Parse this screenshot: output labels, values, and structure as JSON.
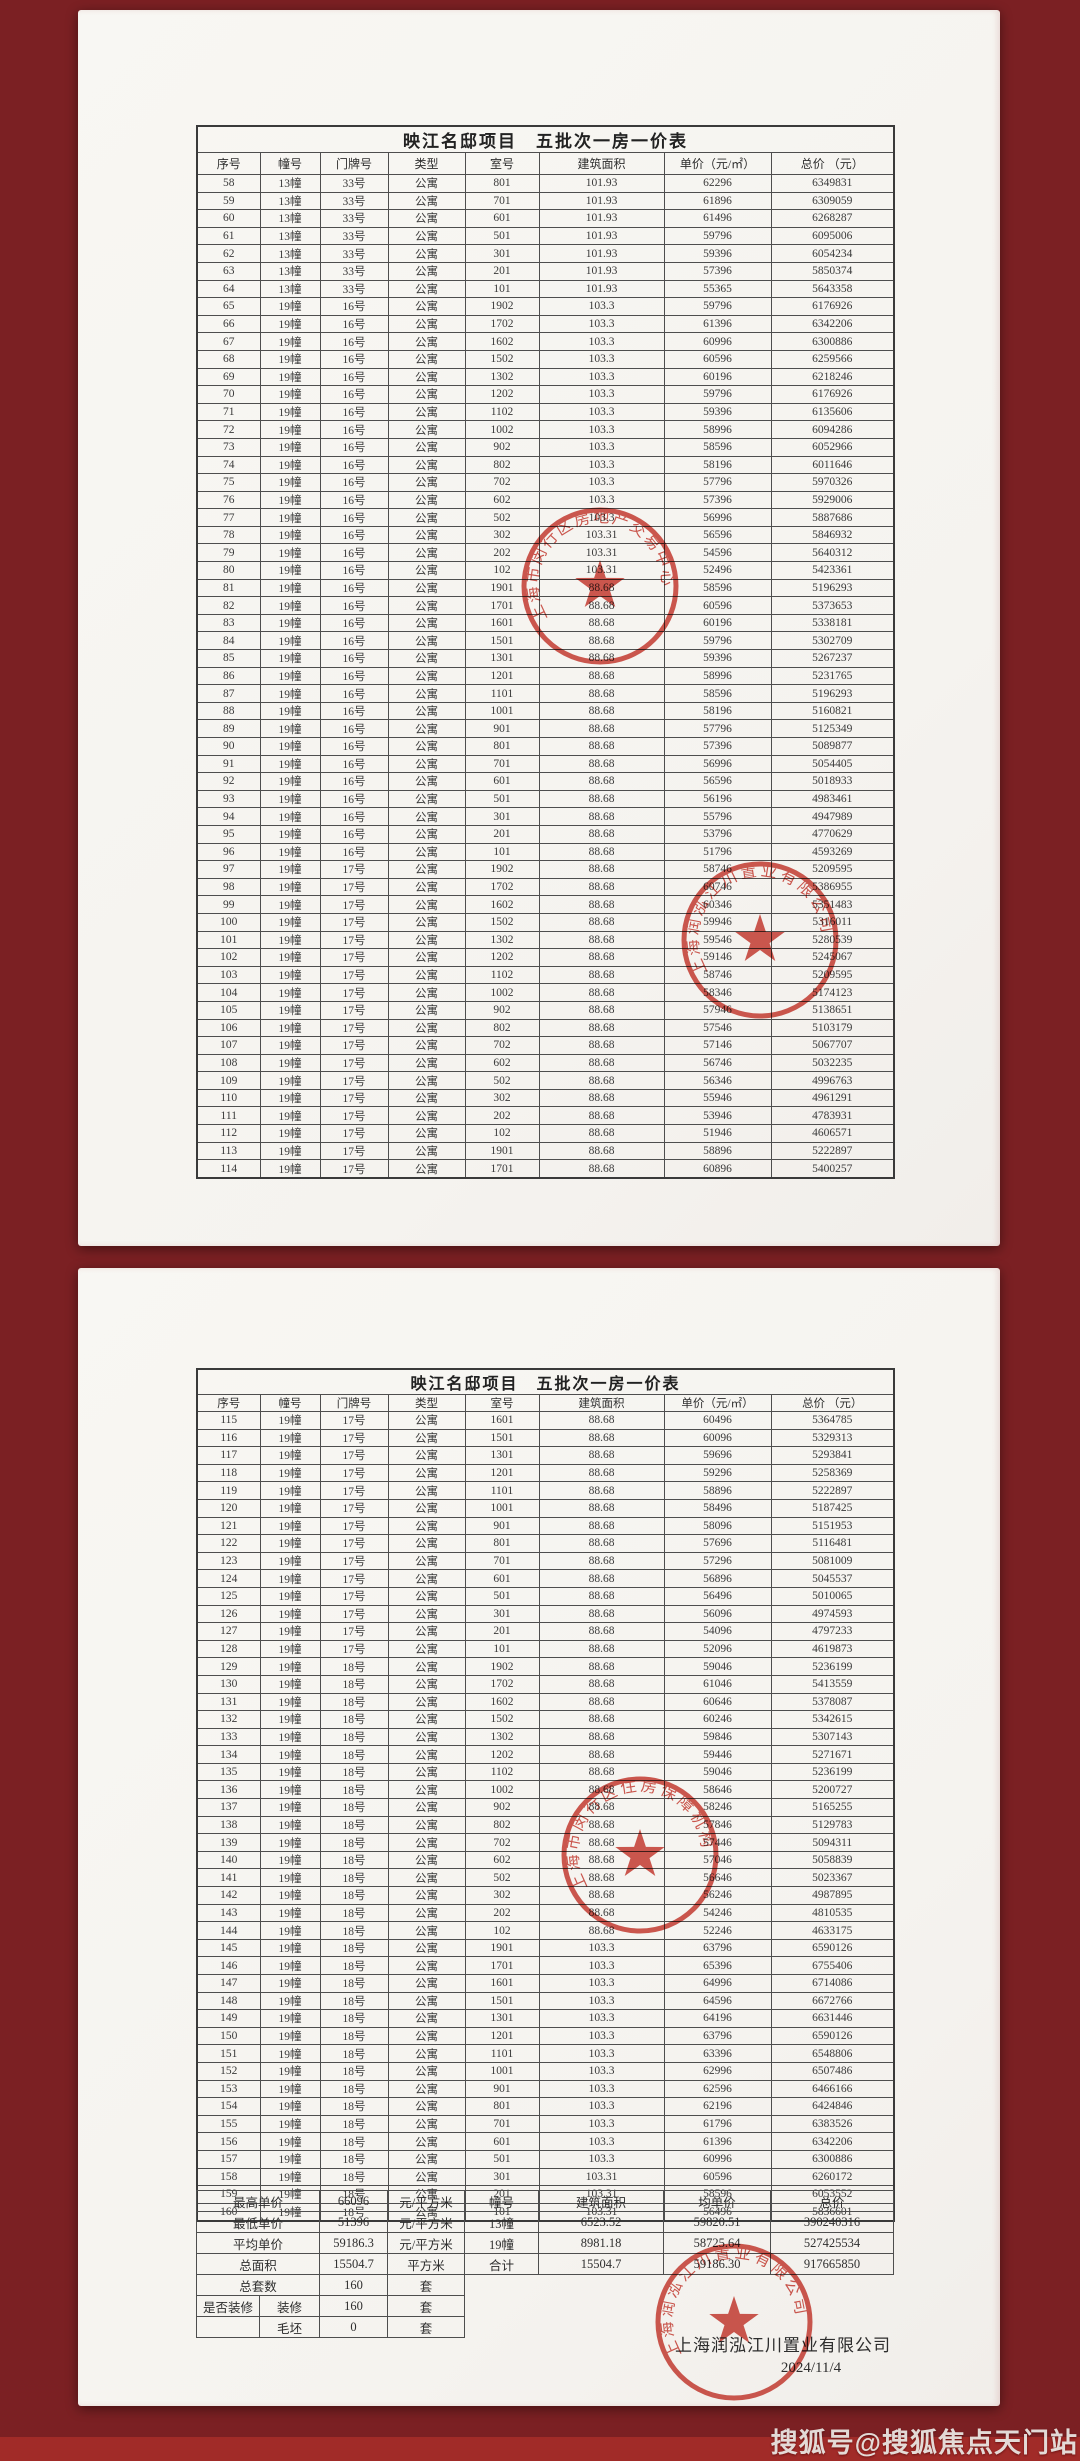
{
  "colors": {
    "background": "#7b2023",
    "bottom_band": "#a12b28",
    "paper": "#f7f5f1",
    "stamp_red": "#c8352b"
  },
  "watermark": "搜狐号@搜狐焦点天门站",
  "doc": {
    "title": "映江名邸项目　五批次一房一价表",
    "headers": [
      "序号",
      "幢号",
      "门牌号",
      "类型",
      "室号",
      "建筑面积",
      "单价（元/㎡）",
      "总价 （元）"
    ]
  },
  "page1": {
    "rows": [
      [
        "58",
        "13幢",
        "33号",
        "公寓",
        "801",
        "101.93",
        "62296",
        "6349831"
      ],
      [
        "59",
        "13幢",
        "33号",
        "公寓",
        "701",
        "101.93",
        "61896",
        "6309059"
      ],
      [
        "60",
        "13幢",
        "33号",
        "公寓",
        "601",
        "101.93",
        "61496",
        "6268287"
      ],
      [
        "61",
        "13幢",
        "33号",
        "公寓",
        "501",
        "101.93",
        "59796",
        "6095006"
      ],
      [
        "62",
        "13幢",
        "33号",
        "公寓",
        "301",
        "101.93",
        "59396",
        "6054234"
      ],
      [
        "63",
        "13幢",
        "33号",
        "公寓",
        "201",
        "101.93",
        "57396",
        "5850374"
      ],
      [
        "64",
        "13幢",
        "33号",
        "公寓",
        "101",
        "101.93",
        "55365",
        "5643358"
      ],
      [
        "65",
        "19幢",
        "16号",
        "公寓",
        "1902",
        "103.3",
        "59796",
        "6176926"
      ],
      [
        "66",
        "19幢",
        "16号",
        "公寓",
        "1702",
        "103.3",
        "61396",
        "6342206"
      ],
      [
        "67",
        "19幢",
        "16号",
        "公寓",
        "1602",
        "103.3",
        "60996",
        "6300886"
      ],
      [
        "68",
        "19幢",
        "16号",
        "公寓",
        "1502",
        "103.3",
        "60596",
        "6259566"
      ],
      [
        "69",
        "19幢",
        "16号",
        "公寓",
        "1302",
        "103.3",
        "60196",
        "6218246"
      ],
      [
        "70",
        "19幢",
        "16号",
        "公寓",
        "1202",
        "103.3",
        "59796",
        "6176926"
      ],
      [
        "71",
        "19幢",
        "16号",
        "公寓",
        "1102",
        "103.3",
        "59396",
        "6135606"
      ],
      [
        "72",
        "19幢",
        "16号",
        "公寓",
        "1002",
        "103.3",
        "58996",
        "6094286"
      ],
      [
        "73",
        "19幢",
        "16号",
        "公寓",
        "902",
        "103.3",
        "58596",
        "6052966"
      ],
      [
        "74",
        "19幢",
        "16号",
        "公寓",
        "802",
        "103.3",
        "58196",
        "6011646"
      ],
      [
        "75",
        "19幢",
        "16号",
        "公寓",
        "702",
        "103.3",
        "57796",
        "5970326"
      ],
      [
        "76",
        "19幢",
        "16号",
        "公寓",
        "602",
        "103.3",
        "57396",
        "5929006"
      ],
      [
        "77",
        "19幢",
        "16号",
        "公寓",
        "502",
        "103.3",
        "56996",
        "5887686"
      ],
      [
        "78",
        "19幢",
        "16号",
        "公寓",
        "302",
        "103.31",
        "56596",
        "5846932"
      ],
      [
        "79",
        "19幢",
        "16号",
        "公寓",
        "202",
        "103.31",
        "54596",
        "5640312"
      ],
      [
        "80",
        "19幢",
        "16号",
        "公寓",
        "102",
        "103.31",
        "52496",
        "5423361"
      ],
      [
        "81",
        "19幢",
        "16号",
        "公寓",
        "1901",
        "88.68",
        "58596",
        "5196293"
      ],
      [
        "82",
        "19幢",
        "16号",
        "公寓",
        "1701",
        "88.68",
        "60596",
        "5373653"
      ],
      [
        "83",
        "19幢",
        "16号",
        "公寓",
        "1601",
        "88.68",
        "60196",
        "5338181"
      ],
      [
        "84",
        "19幢",
        "16号",
        "公寓",
        "1501",
        "88.68",
        "59796",
        "5302709"
      ],
      [
        "85",
        "19幢",
        "16号",
        "公寓",
        "1301",
        "88.68",
        "59396",
        "5267237"
      ],
      [
        "86",
        "19幢",
        "16号",
        "公寓",
        "1201",
        "88.68",
        "58996",
        "5231765"
      ],
      [
        "87",
        "19幢",
        "16号",
        "公寓",
        "1101",
        "88.68",
        "58596",
        "5196293"
      ],
      [
        "88",
        "19幢",
        "16号",
        "公寓",
        "1001",
        "88.68",
        "58196",
        "5160821"
      ],
      [
        "89",
        "19幢",
        "16号",
        "公寓",
        "901",
        "88.68",
        "57796",
        "5125349"
      ],
      [
        "90",
        "19幢",
        "16号",
        "公寓",
        "801",
        "88.68",
        "57396",
        "5089877"
      ],
      [
        "91",
        "19幢",
        "16号",
        "公寓",
        "701",
        "88.68",
        "56996",
        "5054405"
      ],
      [
        "92",
        "19幢",
        "16号",
        "公寓",
        "601",
        "88.68",
        "56596",
        "5018933"
      ],
      [
        "93",
        "19幢",
        "16号",
        "公寓",
        "501",
        "88.68",
        "56196",
        "4983461"
      ],
      [
        "94",
        "19幢",
        "16号",
        "公寓",
        "301",
        "88.68",
        "55796",
        "4947989"
      ],
      [
        "95",
        "19幢",
        "16号",
        "公寓",
        "201",
        "88.68",
        "53796",
        "4770629"
      ],
      [
        "96",
        "19幢",
        "16号",
        "公寓",
        "101",
        "88.68",
        "51796",
        "4593269"
      ],
      [
        "97",
        "19幢",
        "17号",
        "公寓",
        "1902",
        "88.68",
        "58746",
        "5209595"
      ],
      [
        "98",
        "19幢",
        "17号",
        "公寓",
        "1702",
        "88.68",
        "60746",
        "5386955"
      ],
      [
        "99",
        "19幢",
        "17号",
        "公寓",
        "1602",
        "88.68",
        "60346",
        "5351483"
      ],
      [
        "100",
        "19幢",
        "17号",
        "公寓",
        "1502",
        "88.68",
        "59946",
        "5316011"
      ],
      [
        "101",
        "19幢",
        "17号",
        "公寓",
        "1302",
        "88.68",
        "59546",
        "5280539"
      ],
      [
        "102",
        "19幢",
        "17号",
        "公寓",
        "1202",
        "88.68",
        "59146",
        "5245067"
      ],
      [
        "103",
        "19幢",
        "17号",
        "公寓",
        "1102",
        "88.68",
        "58746",
        "5209595"
      ],
      [
        "104",
        "19幢",
        "17号",
        "公寓",
        "1002",
        "88.68",
        "58346",
        "5174123"
      ],
      [
        "105",
        "19幢",
        "17号",
        "公寓",
        "902",
        "88.68",
        "57946",
        "5138651"
      ],
      [
        "106",
        "19幢",
        "17号",
        "公寓",
        "802",
        "88.68",
        "57546",
        "5103179"
      ],
      [
        "107",
        "19幢",
        "17号",
        "公寓",
        "702",
        "88.68",
        "57146",
        "5067707"
      ],
      [
        "108",
        "19幢",
        "17号",
        "公寓",
        "602",
        "88.68",
        "56746",
        "5032235"
      ],
      [
        "109",
        "19幢",
        "17号",
        "公寓",
        "502",
        "88.68",
        "56346",
        "4996763"
      ],
      [
        "110",
        "19幢",
        "17号",
        "公寓",
        "302",
        "88.68",
        "55946",
        "4961291"
      ],
      [
        "111",
        "19幢",
        "17号",
        "公寓",
        "202",
        "88.68",
        "53946",
        "4783931"
      ],
      [
        "112",
        "19幢",
        "17号",
        "公寓",
        "102",
        "88.68",
        "51946",
        "4606571"
      ],
      [
        "113",
        "19幢",
        "17号",
        "公寓",
        "1901",
        "88.68",
        "58896",
        "5222897"
      ],
      [
        "114",
        "19幢",
        "17号",
        "公寓",
        "1701",
        "88.68",
        "60896",
        "5400257"
      ]
    ]
  },
  "page2": {
    "rows": [
      [
        "115",
        "19幢",
        "17号",
        "公寓",
        "1601",
        "88.68",
        "60496",
        "5364785"
      ],
      [
        "116",
        "19幢",
        "17号",
        "公寓",
        "1501",
        "88.68",
        "60096",
        "5329313"
      ],
      [
        "117",
        "19幢",
        "17号",
        "公寓",
        "1301",
        "88.68",
        "59696",
        "5293841"
      ],
      [
        "118",
        "19幢",
        "17号",
        "公寓",
        "1201",
        "88.68",
        "59296",
        "5258369"
      ],
      [
        "119",
        "19幢",
        "17号",
        "公寓",
        "1101",
        "88.68",
        "58896",
        "5222897"
      ],
      [
        "120",
        "19幢",
        "17号",
        "公寓",
        "1001",
        "88.68",
        "58496",
        "5187425"
      ],
      [
        "121",
        "19幢",
        "17号",
        "公寓",
        "901",
        "88.68",
        "58096",
        "5151953"
      ],
      [
        "122",
        "19幢",
        "17号",
        "公寓",
        "801",
        "88.68",
        "57696",
        "5116481"
      ],
      [
        "123",
        "19幢",
        "17号",
        "公寓",
        "701",
        "88.68",
        "57296",
        "5081009"
      ],
      [
        "124",
        "19幢",
        "17号",
        "公寓",
        "601",
        "88.68",
        "56896",
        "5045537"
      ],
      [
        "125",
        "19幢",
        "17号",
        "公寓",
        "501",
        "88.68",
        "56496",
        "5010065"
      ],
      [
        "126",
        "19幢",
        "17号",
        "公寓",
        "301",
        "88.68",
        "56096",
        "4974593"
      ],
      [
        "127",
        "19幢",
        "17号",
        "公寓",
        "201",
        "88.68",
        "54096",
        "4797233"
      ],
      [
        "128",
        "19幢",
        "17号",
        "公寓",
        "101",
        "88.68",
        "52096",
        "4619873"
      ],
      [
        "129",
        "19幢",
        "18号",
        "公寓",
        "1902",
        "88.68",
        "59046",
        "5236199"
      ],
      [
        "130",
        "19幢",
        "18号",
        "公寓",
        "1702",
        "88.68",
        "61046",
        "5413559"
      ],
      [
        "131",
        "19幢",
        "18号",
        "公寓",
        "1602",
        "88.68",
        "60646",
        "5378087"
      ],
      [
        "132",
        "19幢",
        "18号",
        "公寓",
        "1502",
        "88.68",
        "60246",
        "5342615"
      ],
      [
        "133",
        "19幢",
        "18号",
        "公寓",
        "1302",
        "88.68",
        "59846",
        "5307143"
      ],
      [
        "134",
        "19幢",
        "18号",
        "公寓",
        "1202",
        "88.68",
        "59446",
        "5271671"
      ],
      [
        "135",
        "19幢",
        "18号",
        "公寓",
        "1102",
        "88.68",
        "59046",
        "5236199"
      ],
      [
        "136",
        "19幢",
        "18号",
        "公寓",
        "1002",
        "88.68",
        "58646",
        "5200727"
      ],
      [
        "137",
        "19幢",
        "18号",
        "公寓",
        "902",
        "88.68",
        "58246",
        "5165255"
      ],
      [
        "138",
        "19幢",
        "18号",
        "公寓",
        "802",
        "88.68",
        "57846",
        "5129783"
      ],
      [
        "139",
        "19幢",
        "18号",
        "公寓",
        "702",
        "88.68",
        "57446",
        "5094311"
      ],
      [
        "140",
        "19幢",
        "18号",
        "公寓",
        "602",
        "88.68",
        "57046",
        "5058839"
      ],
      [
        "141",
        "19幢",
        "18号",
        "公寓",
        "502",
        "88.68",
        "56646",
        "5023367"
      ],
      [
        "142",
        "19幢",
        "18号",
        "公寓",
        "302",
        "88.68",
        "56246",
        "4987895"
      ],
      [
        "143",
        "19幢",
        "18号",
        "公寓",
        "202",
        "88.68",
        "54246",
        "4810535"
      ],
      [
        "144",
        "19幢",
        "18号",
        "公寓",
        "102",
        "88.68",
        "52246",
        "4633175"
      ],
      [
        "145",
        "19幢",
        "18号",
        "公寓",
        "1901",
        "103.3",
        "63796",
        "6590126"
      ],
      [
        "146",
        "19幢",
        "18号",
        "公寓",
        "1701",
        "103.3",
        "65396",
        "6755406"
      ],
      [
        "147",
        "19幢",
        "18号",
        "公寓",
        "1601",
        "103.3",
        "64996",
        "6714086"
      ],
      [
        "148",
        "19幢",
        "18号",
        "公寓",
        "1501",
        "103.3",
        "64596",
        "6672766"
      ],
      [
        "149",
        "19幢",
        "18号",
        "公寓",
        "1301",
        "103.3",
        "64196",
        "6631446"
      ],
      [
        "150",
        "19幢",
        "18号",
        "公寓",
        "1201",
        "103.3",
        "63796",
        "6590126"
      ],
      [
        "151",
        "19幢",
        "18号",
        "公寓",
        "1101",
        "103.3",
        "63396",
        "6548806"
      ],
      [
        "152",
        "19幢",
        "18号",
        "公寓",
        "1001",
        "103.3",
        "62996",
        "6507486"
      ],
      [
        "153",
        "19幢",
        "18号",
        "公寓",
        "901",
        "103.3",
        "62596",
        "6466166"
      ],
      [
        "154",
        "19幢",
        "18号",
        "公寓",
        "801",
        "103.3",
        "62196",
        "6424846"
      ],
      [
        "155",
        "19幢",
        "18号",
        "公寓",
        "701",
        "103.3",
        "61796",
        "6383526"
      ],
      [
        "156",
        "19幢",
        "18号",
        "公寓",
        "601",
        "103.3",
        "61396",
        "6342206"
      ],
      [
        "157",
        "19幢",
        "18号",
        "公寓",
        "501",
        "103.3",
        "60996",
        "6300886"
      ],
      [
        "158",
        "19幢",
        "18号",
        "公寓",
        "301",
        "103.31",
        "60596",
        "6260172"
      ],
      [
        "159",
        "19幢",
        "18号",
        "公寓",
        "201",
        "103.31",
        "58596",
        "6053552"
      ],
      [
        "160",
        "19幢",
        "18号",
        "公寓",
        "101",
        "103.31",
        "56496",
        "5836601"
      ]
    ],
    "summary": {
      "rows": [
        {
          "label": "最高单价",
          "value": "66096",
          "unit": "元/平方米",
          "right": [
            "幢号",
            "建筑面积",
            "均单价",
            "总价"
          ]
        },
        {
          "label": "最低单价",
          "value": "51396",
          "unit": "元/平方米",
          "right": [
            "13幢",
            "6523.52",
            "59820.51",
            "390240316"
          ]
        },
        {
          "label": "平均单价",
          "value": "59186.3",
          "unit": "元/平方米",
          "right": [
            "19幢",
            "8981.18",
            "58725.64",
            "527425534"
          ]
        },
        {
          "label": "总面积",
          "value": "15504.7",
          "unit": "平方米",
          "right": [
            "合计",
            "15504.7",
            "59186.30",
            "917665850"
          ]
        },
        {
          "label": "总套数",
          "value": "160",
          "unit": "套",
          "right": null
        },
        {
          "label": "是否装修",
          "label2": "装修",
          "value": "160",
          "unit": "套",
          "right": null
        },
        {
          "label": "",
          "label2": "毛坯",
          "value": "0",
          "unit": "套",
          "right": null
        }
      ]
    },
    "company": "上海润泓江川置业有限公司",
    "date": "2024/11/4"
  },
  "stamps": [
    {
      "text": "上海市闵行区房地产交易中心"
    },
    {
      "text": "上海润泓江川置业有限公司"
    },
    {
      "text": "上海市闵行区住房保障机构"
    },
    {
      "text": "上海润泓江川置业有限公司"
    }
  ]
}
